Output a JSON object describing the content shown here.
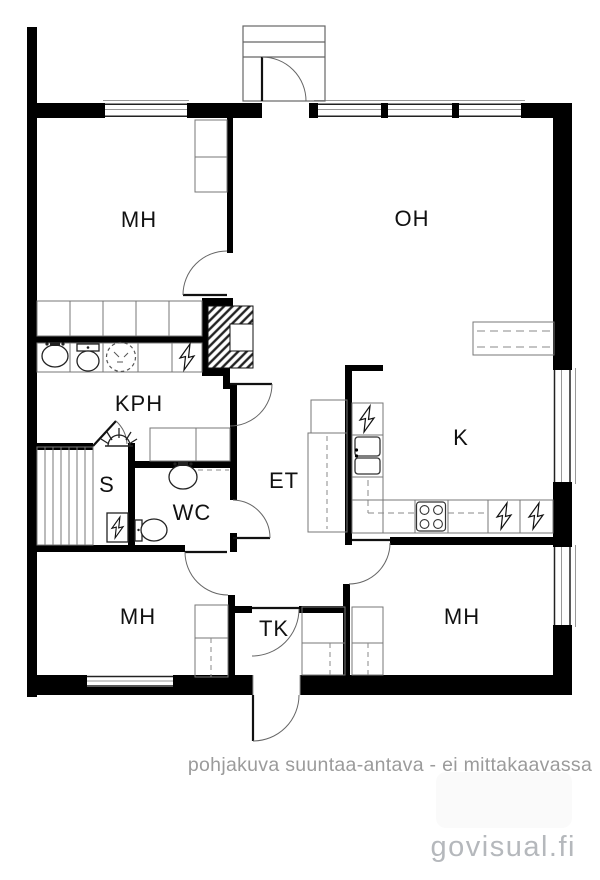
{
  "floor_plan": {
    "type": "floor-plan",
    "labels": {
      "mh_top": "MH",
      "oh": "OH",
      "kph": "KPH",
      "sauna": "S",
      "wc": "WC",
      "hall": "ET",
      "kitchen": "K",
      "mh_bottom_left": "MH",
      "vestibule": "TK",
      "mh_bottom_right": "MH"
    },
    "caption": "pohjakuva suuntaa-antava - ei mittakaavassa",
    "watermark": "govisual.fi",
    "colors": {
      "wall": "#000000",
      "thin_line": "#777777",
      "fixture_line": "#222222",
      "label": "#111111",
      "caption": "#9b9b9b",
      "watermark": "#b5b8bc",
      "background": "#ffffff"
    },
    "icons": {
      "lightning-icon": "electric appliance bolt",
      "toilet-icon": "toilet",
      "washbasin-icon": "washbasin",
      "washing-machine-icon": "dashed-circle washing machine",
      "sauna-heater-icon": "semicircle with rays",
      "sauna-stove-icon": "box with bolt",
      "sink-icon": "double-basin kitchen sink",
      "stove-icon": "four burner circles",
      "sauna-bench-icon": "slatted bench"
    }
  }
}
